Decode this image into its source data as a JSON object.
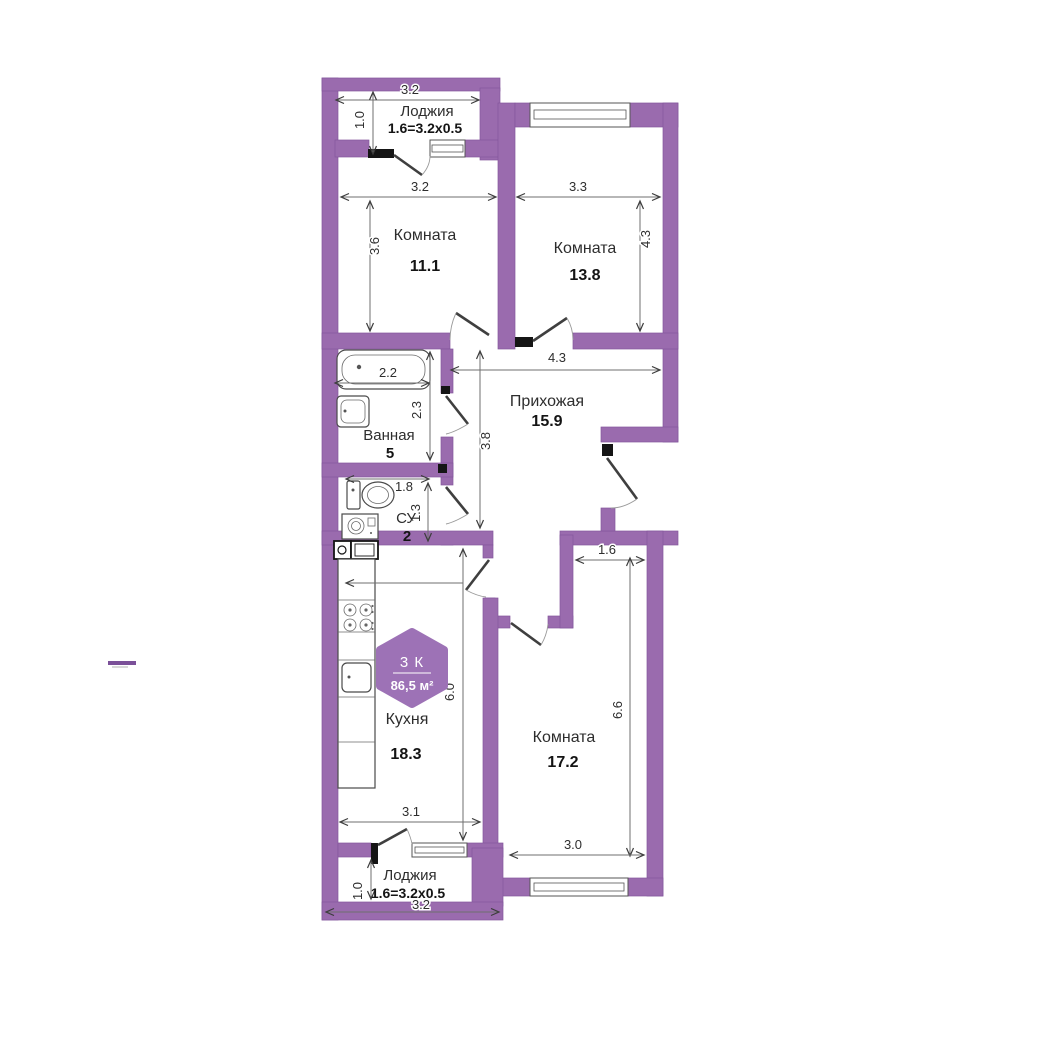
{
  "plan": {
    "badge": {
      "type_label": "3 К",
      "total_area": "86,5 м²"
    },
    "rooms": {
      "loggia_top": {
        "name": "Лоджия",
        "area_formula": "1.6=3.2x0.5",
        "dim_width": "3.2",
        "dim_depth": "1.0"
      },
      "room_a": {
        "name": "Комната",
        "area": "11.1",
        "dim_width": "3.2",
        "dim_height": "3.6"
      },
      "room_b": {
        "name": "Комната",
        "area": "13.8",
        "dim_width": "3.3",
        "dim_height": "4.3"
      },
      "hallway": {
        "name": "Прихожая",
        "area": "15.9",
        "dim_width": "4.3",
        "dim_height": "3.8"
      },
      "bathroom": {
        "name": "Ванная",
        "area": "5",
        "dim_width": "2.2",
        "dim_height": "2.3"
      },
      "wc": {
        "name": "СУ",
        "area": "2",
        "dim_width": "1.8",
        "dim_height": "1.3"
      },
      "kitchen": {
        "name": "Кухня",
        "area": "18.3",
        "dim_height": "6.0",
        "dim_width": "3.1"
      },
      "room_c": {
        "name": "Комната",
        "area": "17.2",
        "dim_top": "1.6",
        "dim_height": "6.6",
        "dim_width": "3.0"
      },
      "loggia_bottom": {
        "name": "Лоджия",
        "area_formula": "1.6=3.2x0.5",
        "dim_depth": "1.0",
        "dim_width": "3.2"
      }
    },
    "colors": {
      "wall": "#9a6bae",
      "badge": "#9d72b6",
      "dim_text": "#2e2e2e"
    }
  }
}
